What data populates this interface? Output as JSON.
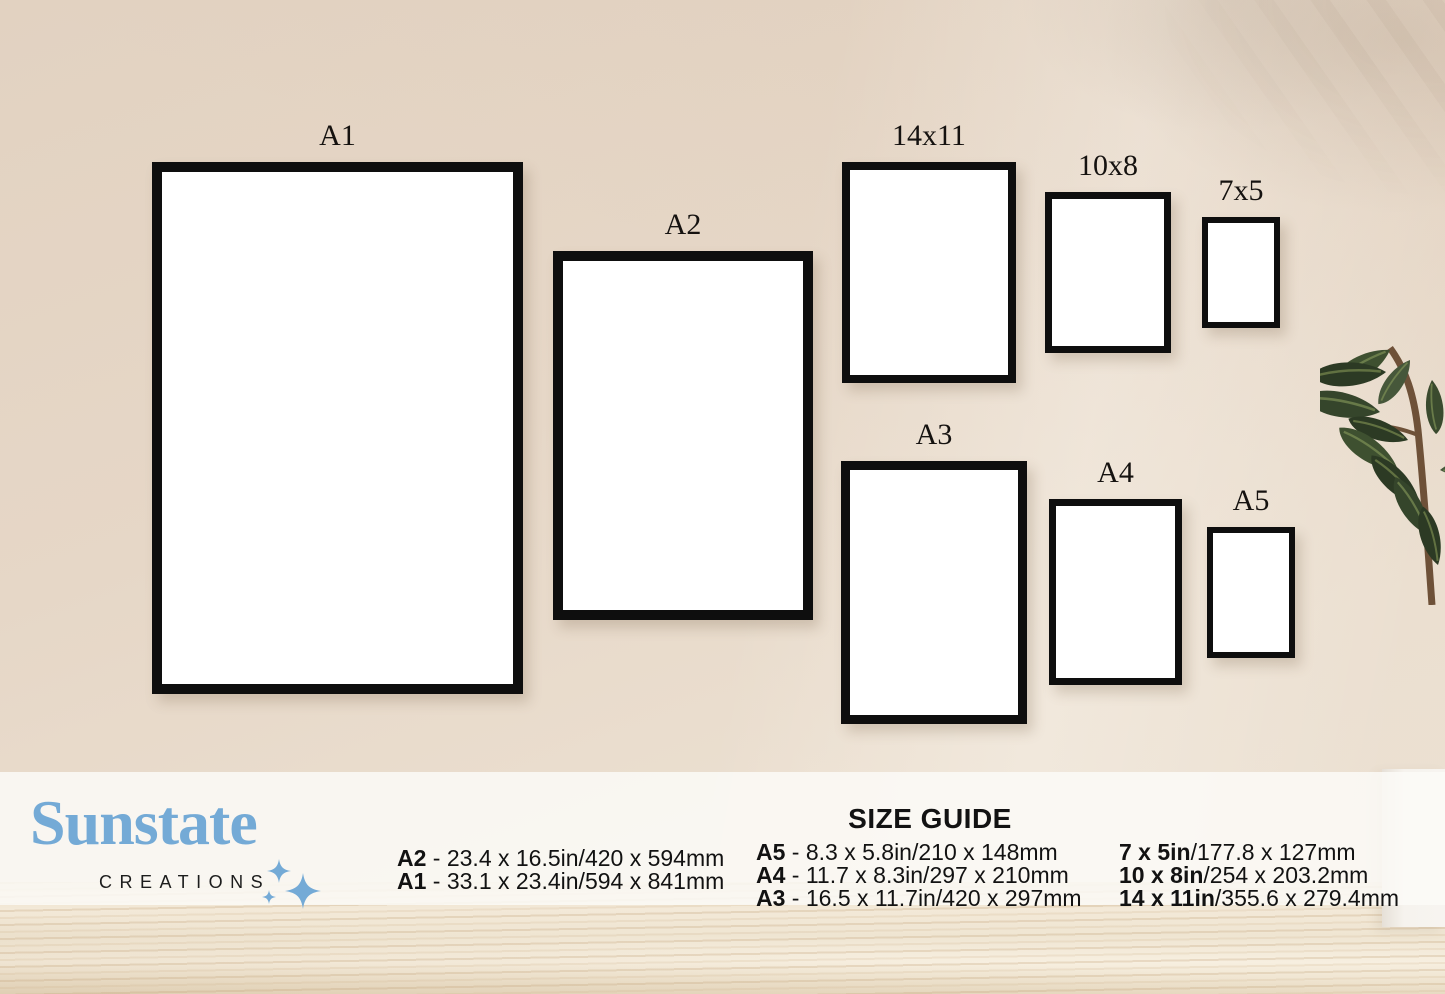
{
  "brand": {
    "name": "Sunstate",
    "subtitle": "CREATIONS"
  },
  "frames": {
    "a1": {
      "label": "A1"
    },
    "a2": {
      "label": "A2"
    },
    "s14x11": {
      "label": "14x11"
    },
    "s10x8": {
      "label": "10x8"
    },
    "s7x5": {
      "label": "7x5"
    },
    "a3": {
      "label": "A3"
    },
    "a4": {
      "label": "A4"
    },
    "a5": {
      "label": "A5"
    }
  },
  "size_guide": {
    "title": "SIZE GUIDE",
    "col1": [
      {
        "name": "A2",
        "dims": " - 23.4 x 16.5in/420 x 594mm"
      },
      {
        "name": "A1",
        "dims": " - 33.1 x 23.4in/594 x 841mm"
      }
    ],
    "col2": [
      {
        "name": "A5",
        "dims": " - 8.3 x 5.8in/210 x 148mm"
      },
      {
        "name": "A4",
        "dims": " - 11.7 x 8.3in/297 x 210mm"
      },
      {
        "name": "A3",
        "dims": " - 16.5 x 11.7in/420 x 297mm"
      }
    ],
    "col3": [
      {
        "name": "7 x 5in",
        "dims": "/177.8 x 127mm"
      },
      {
        "name": "10 x 8in",
        "dims": "/254 x 203.2mm"
      },
      {
        "name": "14 x 11in",
        "dims": "/355.6 x 279.4mm"
      }
    ]
  },
  "colors": {
    "accent": "#74aad6",
    "text": "#121212",
    "frame_border": "#0e0e0e",
    "wall": "#e5d6c6",
    "floor": "#f0e5d3",
    "leaf": "#35452b",
    "stem": "#6e5138"
  }
}
